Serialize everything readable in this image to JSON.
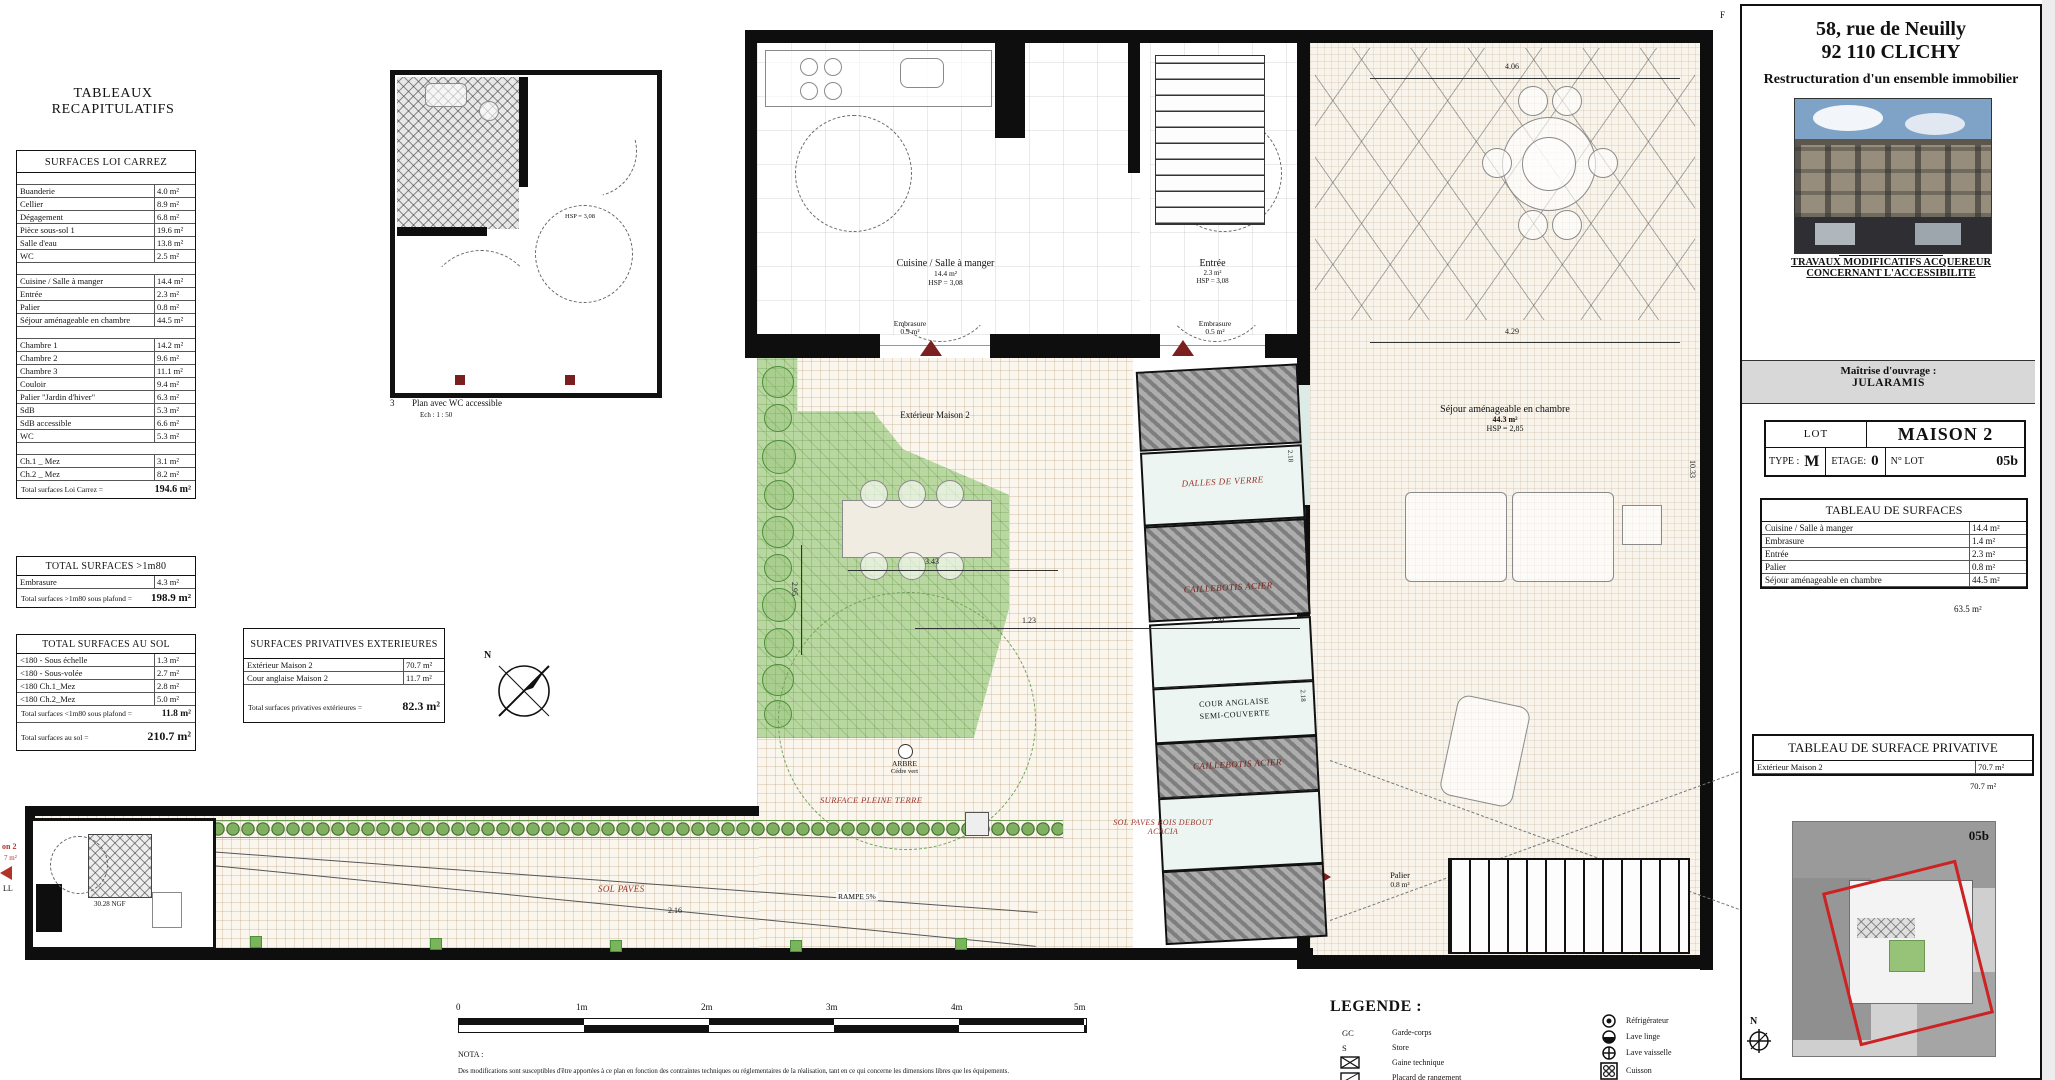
{
  "colors": {
    "accent_red": "#9b342a",
    "wall_black": "#0e0e0e",
    "garden_green": "#b9d8a1",
    "caillebotis_gray": "#8f8f8f",
    "glass_blue": "#ecf5f1",
    "keyplan_red": "#cc2222"
  },
  "left_panel": {
    "title": "TABLEAUX RECAPITULATIFS",
    "carrez": {
      "title": "SURFACES LOI CARREZ",
      "groups": [
        [
          [
            "Buanderie",
            "4.0 m²"
          ],
          [
            "Cellier",
            "8.9 m²"
          ],
          [
            "Dégagement",
            "6.8 m²"
          ],
          [
            "Pièce sous-sol 1",
            "19.6 m²"
          ],
          [
            "Salle d'eau",
            "13.8 m²"
          ],
          [
            "WC",
            "2.5 m²"
          ]
        ],
        [
          [
            "Cuisine / Salle à manger",
            "14.4 m²"
          ],
          [
            "Entrée",
            "2.3 m²"
          ],
          [
            "Palier",
            "0.8 m²"
          ],
          [
            "Séjour aménageable en chambre",
            "44.5 m²"
          ]
        ],
        [
          [
            "Chambre 1",
            "14.2 m²"
          ],
          [
            "Chambre 2",
            "9.6 m²"
          ],
          [
            "Chambre 3",
            "11.1 m²"
          ],
          [
            "Couloir",
            "9.4 m²"
          ],
          [
            "Palier \"Jardin d'hiver\"",
            "6.3 m²"
          ],
          [
            "SdB",
            "5.3 m²"
          ],
          [
            "SdB accessible",
            "6.6 m²"
          ],
          [
            "WC",
            "5.3 m²"
          ]
        ],
        [
          [
            "Ch.1 _ Mez",
            "3.1 m²"
          ],
          [
            "Ch.2 _ Mez",
            "8.2 m²"
          ]
        ]
      ],
      "total_label": "Total surfaces Loi Carrez =",
      "total_value": "194.6 m²"
    },
    "sup180": {
      "title": "TOTAL SURFACES >1m80",
      "rows": [
        [
          "Embrasure",
          "4.3 m²"
        ]
      ],
      "total_label": "Total surfaces >1m80 sous plafond =",
      "total_value": "198.9 m²"
    },
    "au_sol": {
      "title": "TOTAL SURFACES AU SOL",
      "rows": [
        [
          "<180 - Sous échelle",
          "1.3 m²"
        ],
        [
          "<180 - Sous-volée",
          "2.7 m²"
        ],
        [
          "<180 Ch.1_Mez",
          "2.8 m²"
        ],
        [
          "<180 Ch.2_Mez",
          "5.0 m²"
        ]
      ],
      "subtotal_label": "Total surfaces <1m80 sous plafond =",
      "subtotal_value": "11.8 m²",
      "total_label": "Total surfaces au sol =",
      "total_value": "210.7 m²"
    },
    "privatives": {
      "title": "SURFACES PRIVATIVES EXTERIEURES",
      "rows": [
        [
          "Extérieur Maison 2",
          "70.7 m²"
        ],
        [
          "Cour anglaise Maison 2",
          "11.7 m²"
        ]
      ],
      "total_label": "Total surfaces privatives extérieures =",
      "total_value": "82.3 m²"
    }
  },
  "plan": {
    "inset_num": "3",
    "inset_caption": "Plan avec WC accessible",
    "inset_scale": "Ech : 1 : 50",
    "inset_hsp": "HSP = 3,08",
    "kitchen_name": "Cuisine / Salle à manger",
    "kitchen_area": "14.4 m²",
    "kitchen_hsp": "HSP = 3,08",
    "entree_name": "Entrée",
    "entree_area": "2.3 m²",
    "entree_hsp": "HSP = 3,08",
    "embrasure1": "Embrasure",
    "embrasure1_area": "0.9 m²",
    "embrasure2": "Embrasure",
    "embrasure2_area": "0.5 m²",
    "sejour_name": "Séjour aménageable en chambre",
    "sejour_area": "44.3 m²",
    "sejour_hsp": "HSP = 2,85",
    "ext_maison": "Extérieur Maison 2",
    "dalles": "DALLES DE VERRE",
    "caillebotis1": "CAILLEBOTIS ACIER",
    "cour1": "COUR ANGLAISE",
    "cour2": "SEMI-COUVERTE",
    "caillebotis2": "CAILLEBOTIS ACIER",
    "pleine_terre": "SURFACE PLEINE TERRE",
    "sol_paves_bois1": "SOL PAVES BOIS DEBOUT",
    "sol_paves_bois2": "ACACIA",
    "sol_paves": "SOL PAVES",
    "rampe": "RAMPE 5%",
    "palier_name": "Palier",
    "palier_area": "0.8 m²",
    "arbre1": "ARBRE",
    "arbre2": "Cédre vert",
    "ngf": "30.28 NGF",
    "edge_label1": "on 2",
    "edge_label2": "7 m²",
    "edge_label3": "LL",
    "north": "N",
    "grid_ref": "F",
    "dims": {
      "d1": "4.06",
      "d2": "4.29",
      "d3": "3.43",
      "d4": "1.23",
      "d5": "2.59",
      "d6": "2.95",
      "d7": "2.18",
      "d8": "2.18",
      "d9": "10.33",
      "d10": "2.16"
    }
  },
  "scalebar": {
    "ticks": [
      "0",
      "1m",
      "2m",
      "3m",
      "4m",
      "5m"
    ]
  },
  "nota": {
    "title": "NOTA :",
    "text": "Des modifications sont susceptibles d'être apportées à ce plan en fonction des contraintes techniques ou réglementaires de la réalisation, tant en ce qui concerne les dimensions libres que les équipements."
  },
  "legend": {
    "title": "LEGENDE :",
    "left": [
      {
        "key": "GC",
        "label": "Garde-corps"
      },
      {
        "key": "S",
        "label": "Store"
      },
      {
        "key": "",
        "label": "Gaine technique"
      },
      {
        "key": "",
        "label": "Placard de rangement"
      }
    ],
    "right": [
      {
        "label": "Réfrigérateur"
      },
      {
        "label": "Lave linge"
      },
      {
        "label": "Lave vaisselle"
      },
      {
        "label": "Cuisson"
      }
    ]
  },
  "titleblock": {
    "address1": "58, rue de Neuilly",
    "address2": "92 110 CLICHY",
    "subtitle": "Restructuration d'un ensemble immobilier",
    "moa_label": "Maîtrise d'ouvrage :",
    "moa_name": "JULARAMIS",
    "lot": {
      "lot_label": "LOT",
      "lot_value": "MAISON 2",
      "type_label": "TYPE :",
      "type_value": "M",
      "etage_label": "ETAGE:",
      "etage_value": "0",
      "nlot_label": "N° LOT",
      "nlot_value": "05b"
    },
    "surfaces": {
      "title": "TABLEAU DE SURFACES",
      "rows": [
        [
          "Cuisine / Salle à manger",
          "14.4 m²"
        ],
        [
          "Embrasure",
          "1.4 m²"
        ],
        [
          "Entrée",
          "2.3 m²"
        ],
        [
          "Palier",
          "0.8 m²"
        ],
        [
          "Séjour aménageable en chambre",
          "44.5 m²"
        ]
      ],
      "total": "63.5 m²"
    },
    "tma1": "PLAN AVEC \"TMA\" :",
    "tma2": "TRAVAUX MODIFICATIFS ACQUEREUR",
    "tma3": "CONCERNANT L'ACCESSIBILITE",
    "privative": {
      "title": "TABLEAU DE SURFACE PRIVATIVE",
      "rows": [
        [
          "Extérieur Maison 2",
          "70.7 m²"
        ]
      ],
      "total": "70.7 m²"
    },
    "keyplan_lot": "05b",
    "north_label": "N"
  }
}
